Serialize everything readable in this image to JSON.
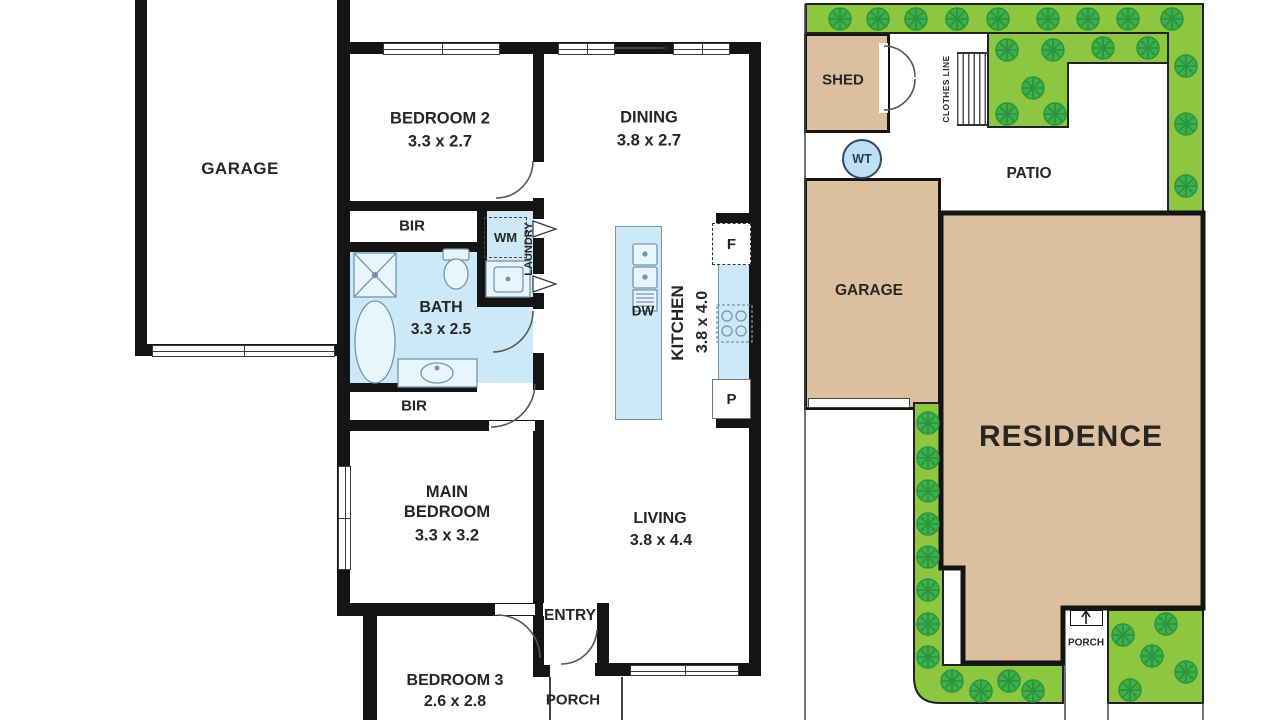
{
  "floorplan": {
    "garage": {
      "label": "GARAGE"
    },
    "bedroom2": {
      "label": "BEDROOM 2",
      "dims": "3.3 x 2.7"
    },
    "dining": {
      "label": "DINING",
      "dims": "3.8 x 2.7"
    },
    "bir_top": {
      "label": "BIR"
    },
    "bir_bottom": {
      "label": "BIR"
    },
    "laundry": {
      "label": "LAUNDRY",
      "wm_label": "WM"
    },
    "bath": {
      "label": "BATH",
      "dims": "3.3 x 2.5"
    },
    "kitchen": {
      "label": "KITCHEN",
      "dims": "3.8 x 4.0",
      "dw_label": "DW",
      "fridge_label": "F",
      "pantry_label": "P"
    },
    "main_bedroom": {
      "label": "MAIN BEDROOM",
      "dims": "3.3 x 3.2"
    },
    "living": {
      "label": "LIVING",
      "dims": "3.8 x 4.4"
    },
    "entry": {
      "label": "ENTRY"
    },
    "bedroom3": {
      "label": "BEDROOM 3",
      "dims": "2.6 x 2.8"
    },
    "porch": {
      "label": "PORCH"
    }
  },
  "siteplan": {
    "shed": {
      "label": "SHED"
    },
    "clothes_line": {
      "label": "CLOTHES LINE"
    },
    "water_tank": {
      "label": "WT"
    },
    "patio": {
      "label": "PATIO"
    },
    "garage": {
      "label": "GARAGE"
    },
    "residence": {
      "label": "RESIDENCE"
    },
    "porch": {
      "label": "PORCH"
    }
  },
  "colors": {
    "wall": "#141414",
    "wet_area_blue": "#cde8f7",
    "building_tan": "#dcc09e",
    "garden_green": "#8dc63f",
    "tree_green": "#3db04a",
    "water_tank_blue": "#bfe0f4"
  }
}
